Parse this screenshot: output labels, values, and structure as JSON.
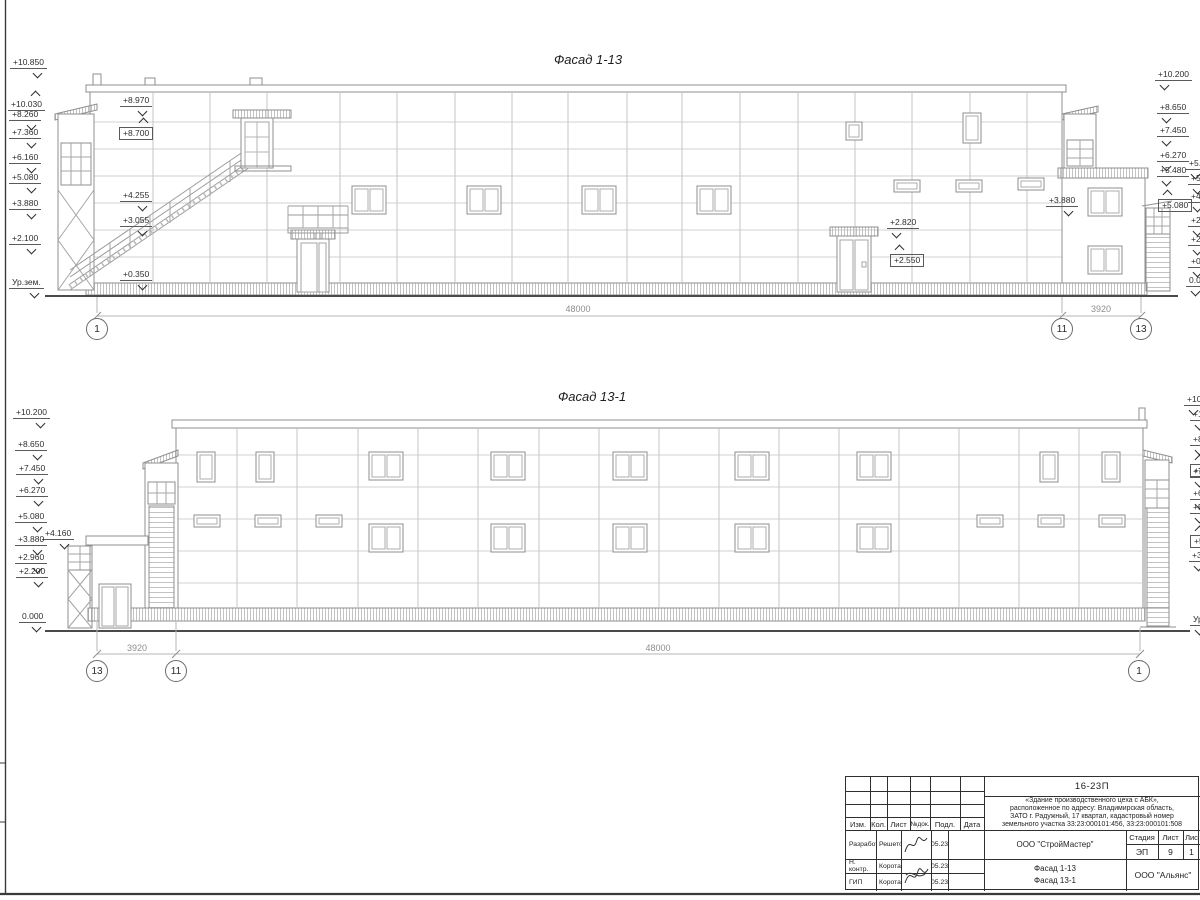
{
  "colors": {
    "paper": "#ffffff",
    "outline": "#8f8f8f",
    "panel_line": "#d2d2d2",
    "ground": "#4a4a4a",
    "text": "#2b2b2b",
    "dim_text": "#8e8e8e",
    "frame": "#3a3a3a"
  },
  "facade1": {
    "title": "Фасад 1-13",
    "left_marks": [
      {
        "label": "+10.850",
        "x": 10,
        "y": 58
      },
      {
        "label": "+10.030",
        "x": 8,
        "y": 92,
        "dir": "up"
      },
      {
        "label": "+8.970",
        "x": 120,
        "y": 96
      },
      {
        "label": "+8.260",
        "x": 9,
        "y": 110
      },
      {
        "label": "+8.700",
        "x": 119,
        "y": 119,
        "dir": "up",
        "boxed": true
      },
      {
        "label": "+7.360",
        "x": 9,
        "y": 128
      },
      {
        "label": "+6.160",
        "x": 9,
        "y": 153
      },
      {
        "label": "+5.080",
        "x": 9,
        "y": 173
      },
      {
        "label": "+4.255",
        "x": 120,
        "y": 191
      },
      {
        "label": "+3.880",
        "x": 9,
        "y": 199
      },
      {
        "label": "+3.055",
        "x": 120,
        "y": 216
      },
      {
        "label": "+2.100",
        "x": 9,
        "y": 234
      },
      {
        "label": "+0.350",
        "x": 120,
        "y": 270
      },
      {
        "label": "Ур.зем.",
        "x": 9,
        "y": 278
      }
    ],
    "right_marks": [
      {
        "label": "+10.200",
        "x": 1155,
        "y": 70
      },
      {
        "label": "+8.650",
        "x": 1157,
        "y": 103
      },
      {
        "label": "+7.450",
        "x": 1157,
        "y": 126
      },
      {
        "label": "+6.270",
        "x": 1157,
        "y": 151
      },
      {
        "label": "+5.480",
        "x": 1157,
        "y": 166
      },
      {
        "label": "+5.080",
        "x": 1158,
        "y": 191,
        "dir": "up",
        "boxed": true
      }
    ],
    "edge_marks": [
      {
        "label": "+5.",
        "x": 1186,
        "y": 159
      },
      {
        "label": "+5.",
        "x": 1188,
        "y": 174
      },
      {
        "label": "+4.",
        "x": 1188,
        "y": 192
      },
      {
        "label": "+2.",
        "x": 1188,
        "y": 216
      },
      {
        "label": "+2.",
        "x": 1188,
        "y": 235
      },
      {
        "label": "+0.",
        "x": 1188,
        "y": 257
      },
      {
        "label": "0.0",
        "x": 1186,
        "y": 276
      }
    ],
    "mid_marks": [
      {
        "label": "+2.820",
        "x": 887,
        "y": 218,
        "side": "r"
      },
      {
        "label": "+2.550",
        "x": 890,
        "y": 246,
        "dir": "up",
        "boxed": true,
        "side": "r"
      },
      {
        "label": "+3.880",
        "x": 1046,
        "y": 196,
        "side": "l"
      }
    ],
    "dims": [
      {
        "label": "48000",
        "x": 548,
        "y": 304,
        "w": 60
      },
      {
        "label": "3920",
        "x": 1078,
        "y": 304,
        "w": 46
      }
    ],
    "bubbles": [
      {
        "label": "1",
        "x": 86,
        "y": 318
      },
      {
        "label": "11",
        "x": 1051,
        "y": 318
      },
      {
        "label": "13",
        "x": 1130,
        "y": 318
      }
    ]
  },
  "facade2": {
    "title": "Фасад 13-1",
    "left_marks": [
      {
        "label": "+10.200",
        "x": 13,
        "y": 408
      },
      {
        "label": "+8.650",
        "x": 15,
        "y": 440
      },
      {
        "label": "+7.450",
        "x": 16,
        "y": 464
      },
      {
        "label": "+6.270",
        "x": 16,
        "y": 486
      },
      {
        "label": "+5.080",
        "x": 15,
        "y": 512
      },
      {
        "label": "+4.160",
        "x": 42,
        "y": 529
      },
      {
        "label": "+3.880",
        "x": 15,
        "y": 535
      },
      {
        "label": "+2.960",
        "x": 15,
        "y": 553
      },
      {
        "label": "+2.200",
        "x": 16,
        "y": 567
      },
      {
        "label": "0.000",
        "x": 19,
        "y": 612
      }
    ],
    "edge_marks": [
      {
        "label": "+10",
        "x": 1184,
        "y": 395
      },
      {
        "label": "+1",
        "x": 1190,
        "y": 410
      },
      {
        "label": "+8",
        "x": 1190,
        "y": 435
      },
      {
        "label": "+8",
        "x": 1190,
        "y": 456,
        "dir": "up",
        "boxed": true
      },
      {
        "label": "+7",
        "x": 1190,
        "y": 467
      },
      {
        "label": "+6",
        "x": 1190,
        "y": 489
      },
      {
        "label": "+5",
        "x": 1190,
        "y": 503
      },
      {
        "label": "+5",
        "x": 1190,
        "y": 527,
        "dir": "up",
        "boxed": true
      },
      {
        "label": "+3",
        "x": 1189,
        "y": 551
      },
      {
        "label": "Ур",
        "x": 1190,
        "y": 615
      }
    ],
    "dims": [
      {
        "label": "3920",
        "x": 114,
        "y": 643,
        "w": 46
      },
      {
        "label": "48000",
        "x": 628,
        "y": 643,
        "w": 60
      }
    ],
    "bubbles": [
      {
        "label": "13",
        "x": 86,
        "y": 660
      },
      {
        "label": "11",
        "x": 165,
        "y": 660
      },
      {
        "label": "1",
        "x": 1128,
        "y": 660
      }
    ]
  },
  "titleblock": {
    "code": "16-23П",
    "description": "«Здание производственного цеха с АБК»,\nрасположенное по адресу: Владимирская область,\nЗАТО г. Радужный, 17 квартал, кадастровый номер\nземельного участка 33:23:000101:456, 33:23:000101:508",
    "cols": [
      "Изм.",
      "Кол.",
      "Лист",
      "№док.",
      "Подл.",
      "Дата"
    ],
    "rows": [
      {
        "role": "Разработал",
        "name": "Решетова",
        "date": "05.23"
      },
      {
        "role": "Н. контр.",
        "name": "Коротаев",
        "date": "05.23"
      },
      {
        "role": "ГИП",
        "name": "Коротаев",
        "date": "05.23"
      }
    ],
    "org": "ООО \"СтройМастер\"",
    "stage_label": "Стадия",
    "sheet_label": "Лист",
    "sheets_label": "Лис",
    "stage": "ЭП",
    "sheet_num": "9",
    "sheets_num": "1",
    "drawing_names": "Фасад 1-13\nФасад 13-1",
    "contractor": "ООО \"Альянс\""
  }
}
